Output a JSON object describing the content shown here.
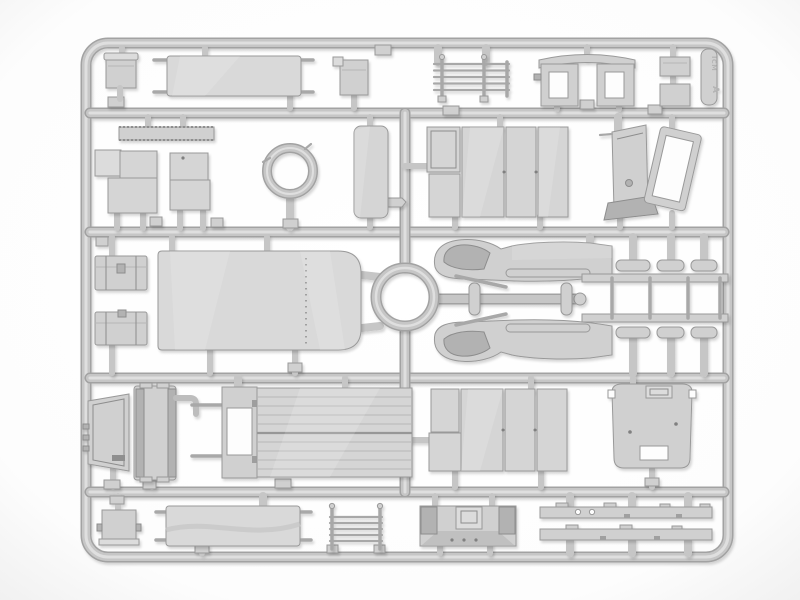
{
  "scene": {
    "description": "Product photo of a light grey injection-moulded plastic model-kit sprue (parts tree) on a white background. The rectangular runner frame holds vehicle parts: stretchers, storage boxes and chests, a slatted bench, cab rear wall with two windows, windscreen frame and cowl, door and side panels, a large canvas tilt, two rings, two mirrored front fenders, a ladder sub-frame with tie-rod pins, radiator and grille, planked cargo floor, cab roof, dashboard bulkhead and two chassis rails."
  },
  "sprue_tab": {
    "logo": "ICM",
    "letter": "A"
  },
  "colors": {
    "bg": "#ffffff",
    "vignette": "#ededed",
    "runner_edge": "#a2a2a2",
    "runner_mid": "#c6c6c6",
    "runner_hi": "#dfdfdf",
    "plastic": "#d0d0d0",
    "plastic_light": "#dcdcdc",
    "plastic_dark": "#b2b2b2",
    "panel": "#d5d5d5",
    "canvas": "#d9d9d9",
    "edge": "#999999",
    "detail": "#8d8d8d",
    "hole": "#fdfdfd",
    "emboss": "#b4b4b4"
  }
}
